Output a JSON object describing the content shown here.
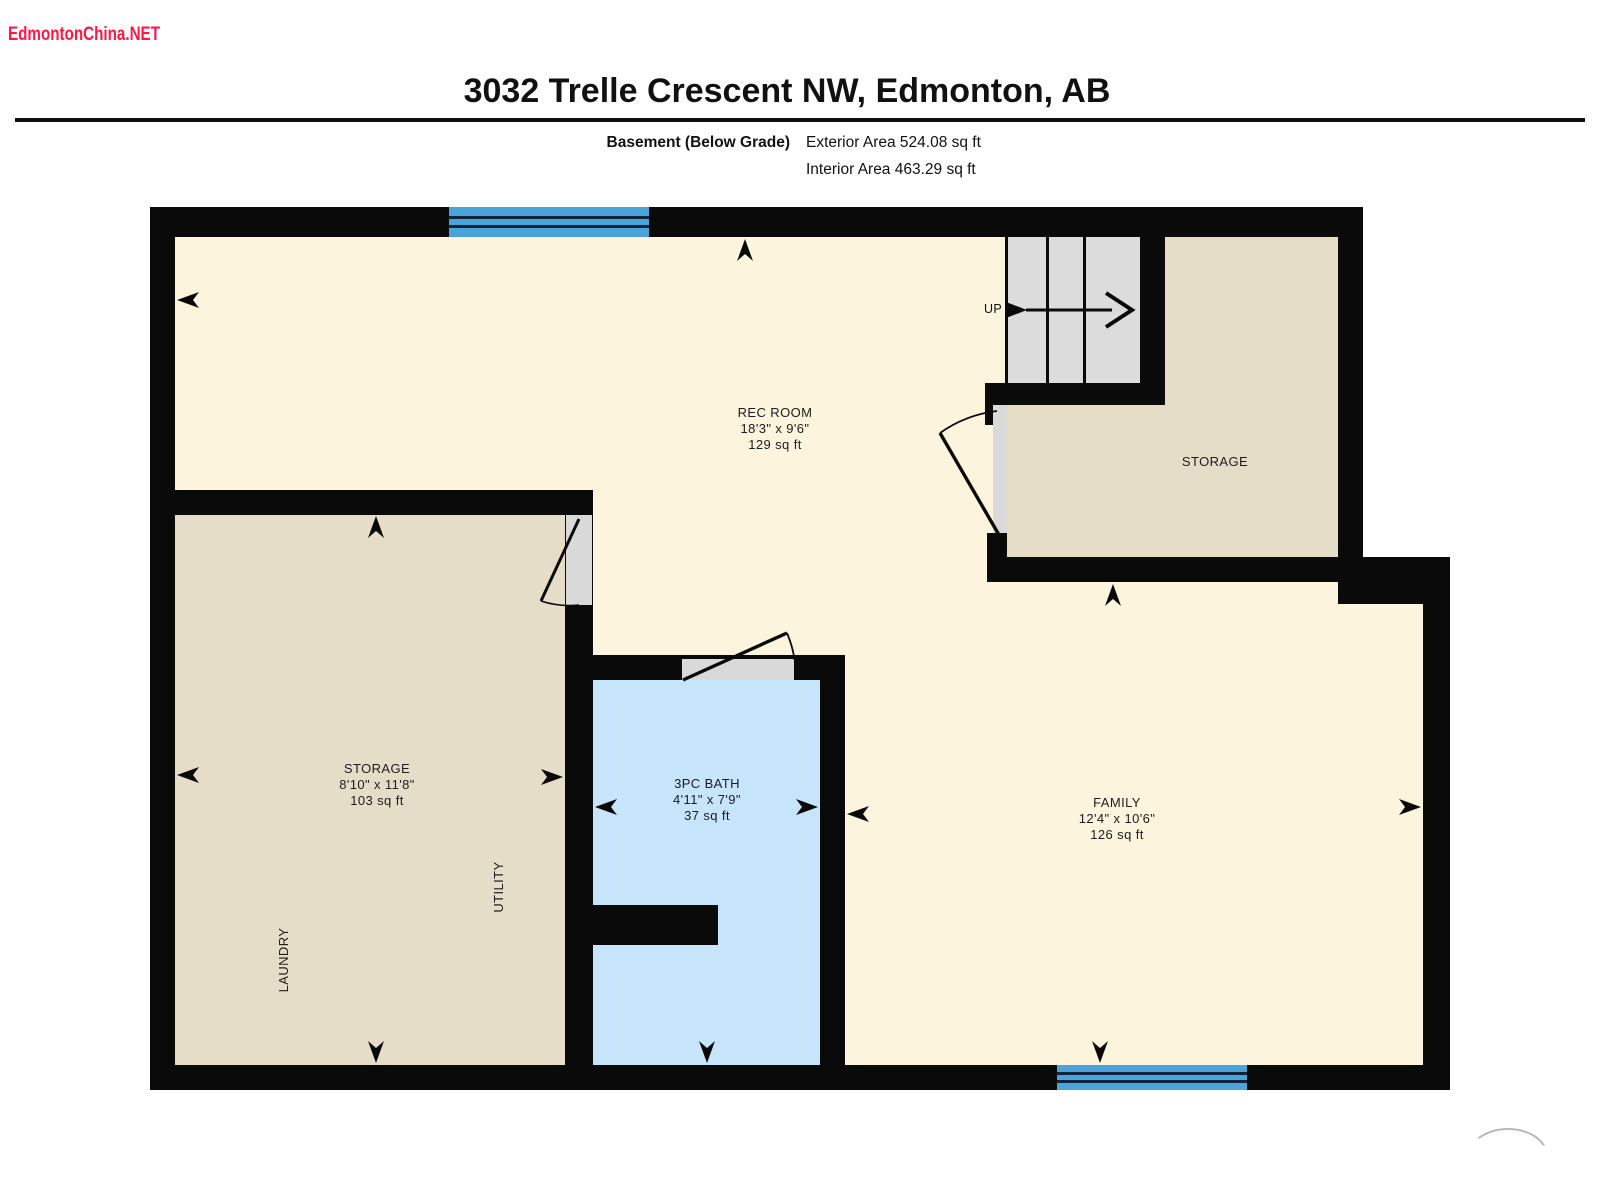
{
  "watermark": {
    "text": "EdmontonChina.NET",
    "color": "#ff1743"
  },
  "header": {
    "title": "3032 Trelle Crescent NW, Edmonton, AB",
    "floor_label": "Basement (Below Grade)",
    "exterior_area": "Exterior Area 524.08 sq ft",
    "interior_area": "Interior Area 463.29 sq ft"
  },
  "rooms": {
    "rec_room": {
      "name": "REC ROOM",
      "dimensions": "18'3\" x 9'6\"",
      "area": "129 sq ft"
    },
    "storage_right": {
      "name": "STORAGE"
    },
    "storage_left": {
      "name": "STORAGE",
      "dimensions": "8'10\" x 11'8\"",
      "area": "103 sq ft"
    },
    "bath": {
      "name": "3PC BATH",
      "dimensions": "4'11\" x 7'9\"",
      "area": "37 sq ft"
    },
    "family": {
      "name": "FAMILY",
      "dimensions": "12'4\" x 10'6\"",
      "area": "126 sq ft"
    },
    "utility": {
      "name": "UTILITY"
    },
    "laundry": {
      "name": "LAUNDRY"
    },
    "stairs": {
      "label": "UP"
    }
  },
  "colors": {
    "wall": "#0a0a0a",
    "room_cream": "#fdf4dd",
    "room_tan": "#e6ddc9",
    "bath_blue": "#c6e4fa",
    "window_blue": "#4aa4d9",
    "stair_gray": "#dcdcdc",
    "door_gray": "#d9d9d9",
    "watermark_red": "#ff1743"
  }
}
